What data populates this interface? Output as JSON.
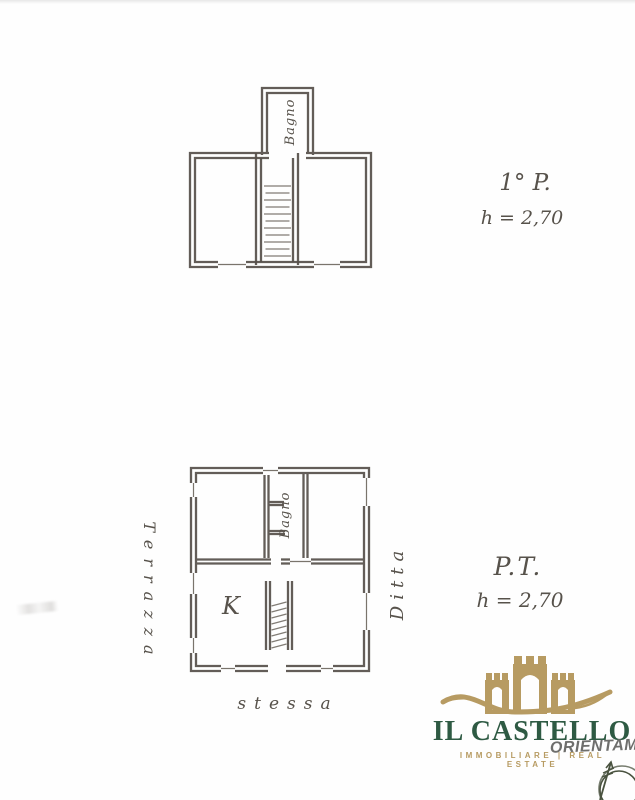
{
  "document": {
    "type_label": "floor plan scan",
    "background": "#fefefe",
    "ink_color": "#56504a",
    "handwriting_color": "#57524b"
  },
  "plan_top": {
    "floor_label": "1° P.",
    "height_label": "h = 2,70",
    "bath_label": "Bagno"
  },
  "plan_bottom": {
    "floor_label": "P.T.",
    "height_label": "h = 2,70",
    "bath_label": "Bagno",
    "kitchen_label": "K"
  },
  "annotations": {
    "left_vertical_label": "Terrazza",
    "right_vertical_label": "Ditta",
    "bottom_label": "stessa",
    "orientation_text": "ORIENTAME"
  },
  "logo": {
    "title": "IL CASTELLO",
    "tagline": "IMMOBILIARE | REAL ESTATE",
    "brand_green": "#2e5a43",
    "brand_gold": "#b79b62"
  }
}
